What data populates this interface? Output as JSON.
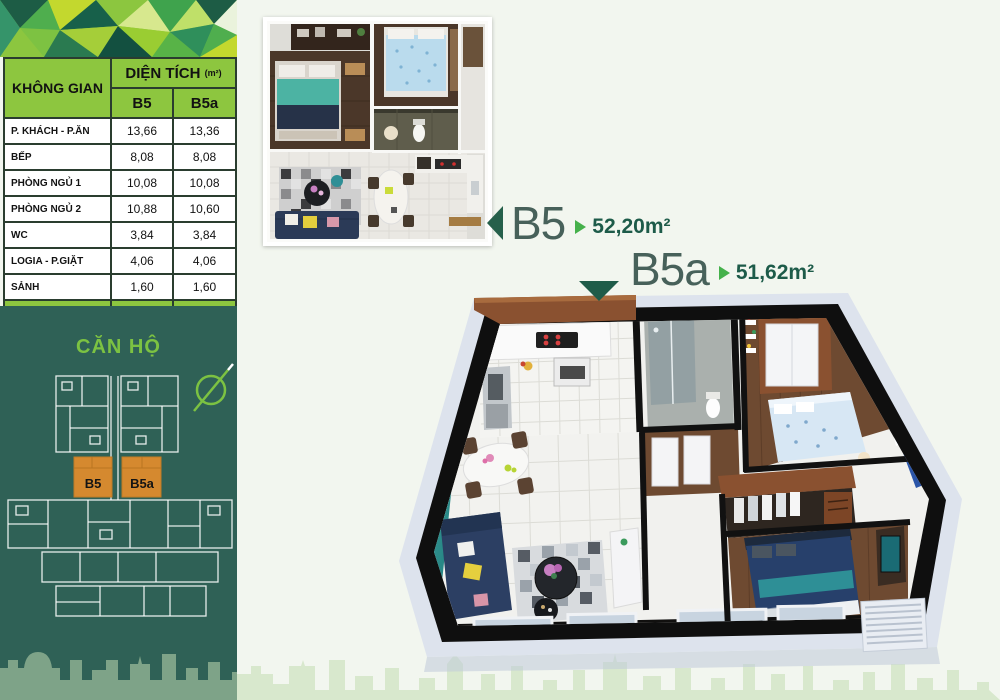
{
  "table": {
    "space_header": "KHÔNG GIAN",
    "area_header": "DIỆN TÍCH",
    "area_unit": "(m²)",
    "col_b5": "B5",
    "col_b5a": "B5a",
    "rows": [
      {
        "label": "P. KHÁCH - P.ĂN",
        "b5": "13,66",
        "b5a": "13,36"
      },
      {
        "label": "BẾP",
        "b5": "8,08",
        "b5a": "8,08"
      },
      {
        "label": "PHÒNG NGỦ 1",
        "b5": "10,08",
        "b5a": "10,08"
      },
      {
        "label": "PHÒNG NGỦ 2",
        "b5": "10,88",
        "b5a": "10,60"
      },
      {
        "label": "WC",
        "b5": "3,84",
        "b5a": "3,84"
      },
      {
        "label": "LOGIA - P.GIẶT",
        "b5": "4,06",
        "b5a": "4,06"
      },
      {
        "label": "SẢNH",
        "b5": "1,60",
        "b5a": "1,60"
      }
    ],
    "total": {
      "label": "TỔNG",
      "b5": "52,20",
      "b5a": "51,62"
    }
  },
  "keyplan": {
    "title": "CĂN HỘ",
    "unit_b5": "B5",
    "unit_b5a": "B5a"
  },
  "units": {
    "b5": {
      "name": "B5",
      "area": "52,20m²"
    },
    "b5a": {
      "name": "B5a",
      "area": "51,62m²"
    }
  },
  "colors": {
    "accent_green": "#8dc63f",
    "bright_green": "#7cc242",
    "dark_teal_panel": "#2f6156",
    "dark_green_text": "#1d5b49",
    "unit_highlight_orange": "#d5892f"
  }
}
